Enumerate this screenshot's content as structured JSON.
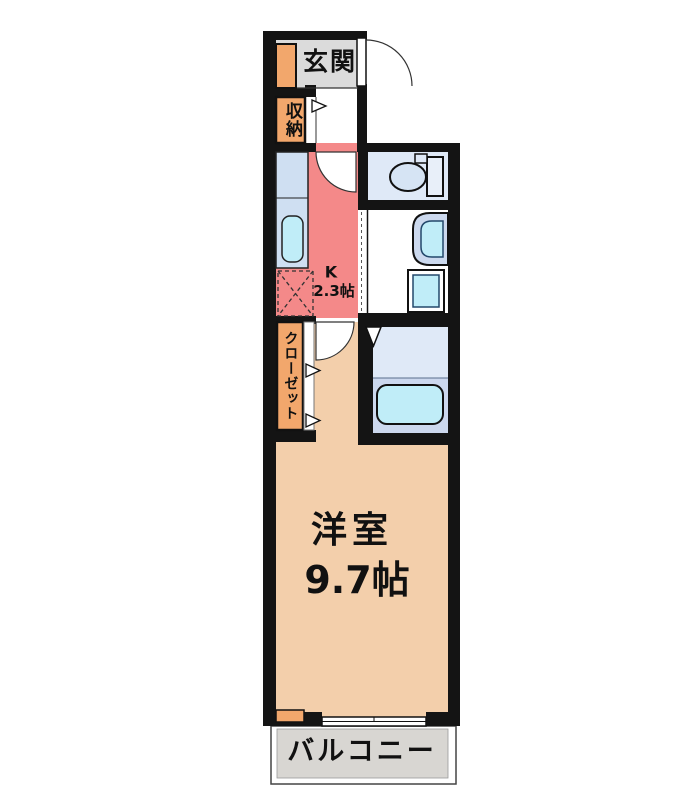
{
  "plan": {
    "entrance": {
      "label": "玄関"
    },
    "storage": {
      "label": "収納"
    },
    "kitchen": {
      "label": "K",
      "size": "2.3帖"
    },
    "closet": {
      "label": "クローゼット"
    },
    "main_room": {
      "label": "洋室",
      "size": "9.7帖"
    },
    "balcony": {
      "label": "バルコニー"
    },
    "colors": {
      "wall": "#141414",
      "entrance_floor": "#dbdbdb",
      "balcony_floor": "#d8d6d2",
      "storage_orange": "#f2a76c",
      "kitchen_pink": "#f48989",
      "room_peach": "#f3cfab",
      "counter_blue": "#cfdff2",
      "wet_floor_blue": "#dfe9f7",
      "bath_floor_blue": "#ccd8ee",
      "fixture_cyan": "#c0edf8"
    }
  }
}
